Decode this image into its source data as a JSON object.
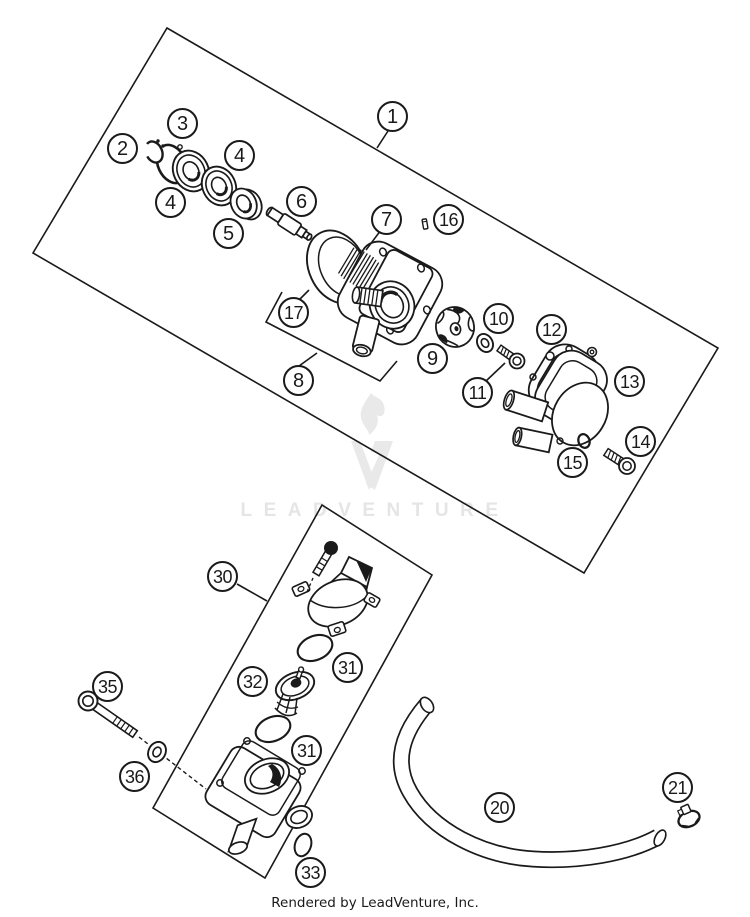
{
  "diagram": {
    "watermark": "LEADVENTURE",
    "footer": "Rendered by LeadVenture, Inc."
  },
  "colors": {
    "line": "#1a1a1a",
    "watermark": "#e7e7e7",
    "background": "#ffffff"
  },
  "callouts": [
    {
      "label": "1"
    },
    {
      "label": "2"
    },
    {
      "label": "3"
    },
    {
      "label": "4"
    },
    {
      "label": "4"
    },
    {
      "label": "5"
    },
    {
      "label": "6"
    },
    {
      "label": "7"
    },
    {
      "label": "8"
    },
    {
      "label": "9"
    },
    {
      "label": "10"
    },
    {
      "label": "11"
    },
    {
      "label": "12"
    },
    {
      "label": "13"
    },
    {
      "label": "14"
    },
    {
      "label": "15"
    },
    {
      "label": "16"
    },
    {
      "label": "17"
    },
    {
      "label": "20"
    },
    {
      "label": "21"
    },
    {
      "label": "30"
    },
    {
      "label": "31"
    },
    {
      "label": "31"
    },
    {
      "label": "32"
    },
    {
      "label": "33"
    },
    {
      "label": "35"
    },
    {
      "label": "36"
    }
  ]
}
